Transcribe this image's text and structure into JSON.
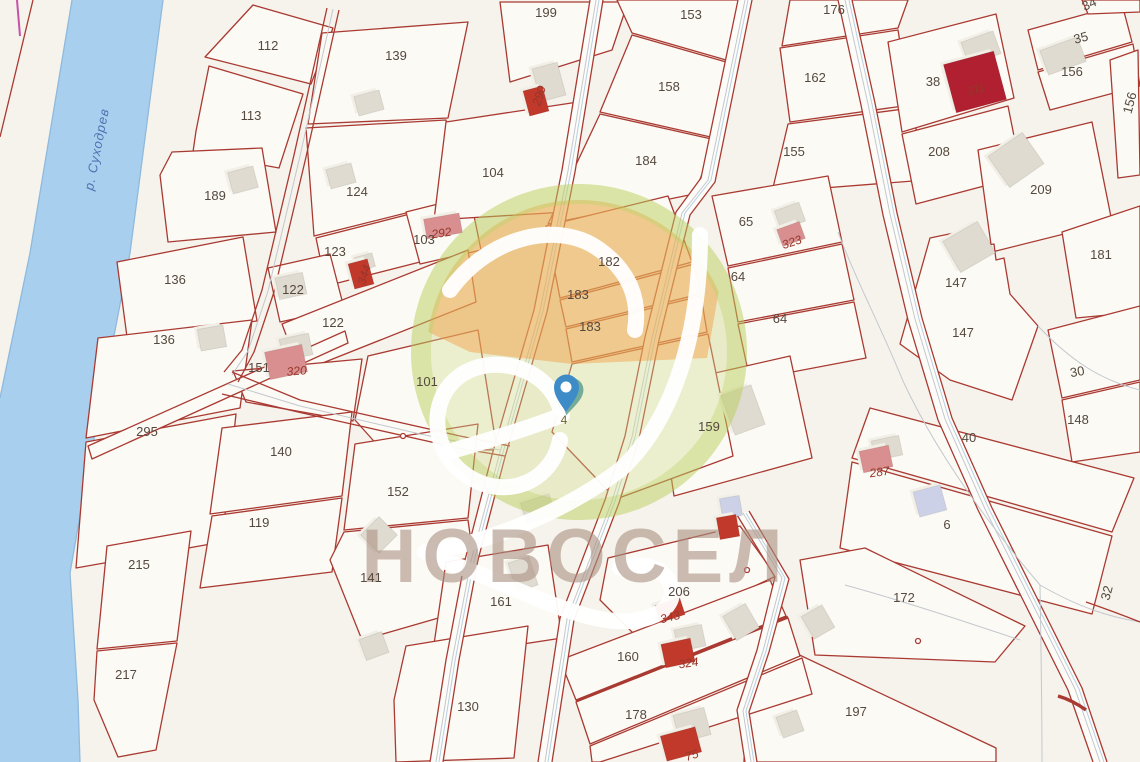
{
  "map": {
    "river": {
      "label": "р. Суходрев"
    },
    "marker": {
      "label": "4"
    },
    "watermark": {
      "brand": "НОВОСЕЛ"
    },
    "colors": {
      "parcel_line": "#a93a32",
      "river_fill": "#a9cfee",
      "highlight_orange": "#f39c3f",
      "watermark_green": "#bacd5a",
      "pin_blue": "#3e8cc7",
      "pin_teal": "#5fa08f",
      "building_gray": "#dfdbd0",
      "building_red": "#c0392b",
      "building_pink": "#d98f8f",
      "building_lavender": "#cdd1e7"
    },
    "parcel_labels": [
      {
        "text": "112",
        "x": 268,
        "y": 50,
        "rot": 0
      },
      {
        "text": "113",
        "x": 251,
        "y": 120,
        "rot": 0
      },
      {
        "text": "189",
        "x": 215,
        "y": 200,
        "rot": 0
      },
      {
        "text": "136",
        "x": 175,
        "y": 284,
        "rot": 0
      },
      {
        "text": "136",
        "x": 164,
        "y": 344,
        "rot": 0
      },
      {
        "text": "295",
        "x": 147,
        "y": 436,
        "rot": 0
      },
      {
        "text": "215",
        "x": 139,
        "y": 569,
        "rot": 0
      },
      {
        "text": "217",
        "x": 126,
        "y": 679,
        "rot": 0
      },
      {
        "text": "139",
        "x": 396,
        "y": 60,
        "rot": 0
      },
      {
        "text": "124",
        "x": 357,
        "y": 196,
        "rot": 0
      },
      {
        "text": "123",
        "x": 335,
        "y": 256,
        "rot": 0
      },
      {
        "text": "103",
        "x": 424,
        "y": 244,
        "rot": 0
      },
      {
        "text": "122",
        "x": 293,
        "y": 294,
        "rot": 0
      },
      {
        "text": "122",
        "x": 333,
        "y": 327,
        "rot": 0
      },
      {
        "text": "151",
        "x": 259,
        "y": 372,
        "rot": 0
      },
      {
        "text": "101",
        "x": 427,
        "y": 386,
        "rot": 0
      },
      {
        "text": "140",
        "x": 281,
        "y": 456,
        "rot": 0
      },
      {
        "text": "152",
        "x": 398,
        "y": 496,
        "rot": 0
      },
      {
        "text": "119",
        "x": 259,
        "y": 527,
        "rot": 0
      },
      {
        "text": "141",
        "x": 371,
        "y": 582,
        "rot": 0
      },
      {
        "text": "161",
        "x": 501,
        "y": 606,
        "rot": 0
      },
      {
        "text": "130",
        "x": 468,
        "y": 711,
        "rot": 0
      },
      {
        "text": "199",
        "x": 546,
        "y": 17,
        "rot": 0
      },
      {
        "text": "104",
        "x": 493,
        "y": 177,
        "rot": 0
      },
      {
        "text": "182",
        "x": 609,
        "y": 266,
        "rot": 0
      },
      {
        "text": "183",
        "x": 578,
        "y": 299,
        "rot": 0
      },
      {
        "text": "183",
        "x": 590,
        "y": 331,
        "rot": 0
      },
      {
        "text": "153",
        "x": 691,
        "y": 19,
        "rot": 0
      },
      {
        "text": "158",
        "x": 669,
        "y": 91,
        "rot": 0
      },
      {
        "text": "184",
        "x": 646,
        "y": 165,
        "rot": 0
      },
      {
        "text": "176",
        "x": 834,
        "y": 14,
        "rot": 0
      },
      {
        "text": "162",
        "x": 815,
        "y": 82,
        "rot": 0
      },
      {
        "text": "155",
        "x": 794,
        "y": 156,
        "rot": 0
      },
      {
        "text": "65",
        "x": 746,
        "y": 226,
        "rot": 0
      },
      {
        "text": "64",
        "x": 738,
        "y": 281,
        "rot": 0
      },
      {
        "text": "64",
        "x": 780,
        "y": 323,
        "rot": 0
      },
      {
        "text": "159",
        "x": 709,
        "y": 431,
        "rot": 0
      },
      {
        "text": "206",
        "x": 679,
        "y": 596,
        "rot": 0
      },
      {
        "text": "160",
        "x": 628,
        "y": 661,
        "rot": 0
      },
      {
        "text": "178",
        "x": 636,
        "y": 719,
        "rot": 0
      },
      {
        "text": "38",
        "x": 933,
        "y": 86,
        "rot": 0
      },
      {
        "text": "208",
        "x": 939,
        "y": 156,
        "rot": 0
      },
      {
        "text": "209",
        "x": 1041,
        "y": 194,
        "rot": 0
      },
      {
        "text": "35",
        "x": 1082,
        "y": 42,
        "rot": -15
      },
      {
        "text": "34",
        "x": 1091,
        "y": 8,
        "rot": -25
      },
      {
        "text": "156",
        "x": 1072,
        "y": 76,
        "rot": 0
      },
      {
        "text": "156",
        "x": 1134,
        "y": 104,
        "rot": -75
      },
      {
        "text": "181",
        "x": 1101,
        "y": 259,
        "rot": 0
      },
      {
        "text": "147",
        "x": 956,
        "y": 287,
        "rot": 0
      },
      {
        "text": "147",
        "x": 963,
        "y": 337,
        "rot": 0
      },
      {
        "text": "30",
        "x": 1078,
        "y": 376,
        "rot": -10
      },
      {
        "text": "148",
        "x": 1078,
        "y": 424,
        "rot": 0
      },
      {
        "text": "40",
        "x": 969,
        "y": 442,
        "rot": 0
      },
      {
        "text": "6",
        "x": 947,
        "y": 529,
        "rot": 0
      },
      {
        "text": "172",
        "x": 904,
        "y": 602,
        "rot": 0
      },
      {
        "text": "197",
        "x": 856,
        "y": 716,
        "rot": 0
      },
      {
        "text": "32",
        "x": 1111,
        "y": 594,
        "rot": -75
      }
    ],
    "building_labels": [
      {
        "text": "290",
        "x": 543,
        "y": 97,
        "rot": -72
      },
      {
        "text": "292",
        "x": 442,
        "y": 237,
        "rot": -8
      },
      {
        "text": "344",
        "x": 368,
        "y": 276,
        "rot": -72
      },
      {
        "text": "311",
        "x": 977,
        "y": 93,
        "rot": -18
      },
      {
        "text": "323",
        "x": 793,
        "y": 246,
        "rot": -18
      },
      {
        "text": "320",
        "x": 297,
        "y": 375,
        "rot": -5
      },
      {
        "text": "287",
        "x": 880,
        "y": 476,
        "rot": -8
      },
      {
        "text": "343",
        "x": 671,
        "y": 621,
        "rot": -14
      },
      {
        "text": "324",
        "x": 689,
        "y": 667,
        "rot": -8
      },
      {
        "text": "75",
        "x": 693,
        "y": 759,
        "rot": -18
      }
    ]
  }
}
